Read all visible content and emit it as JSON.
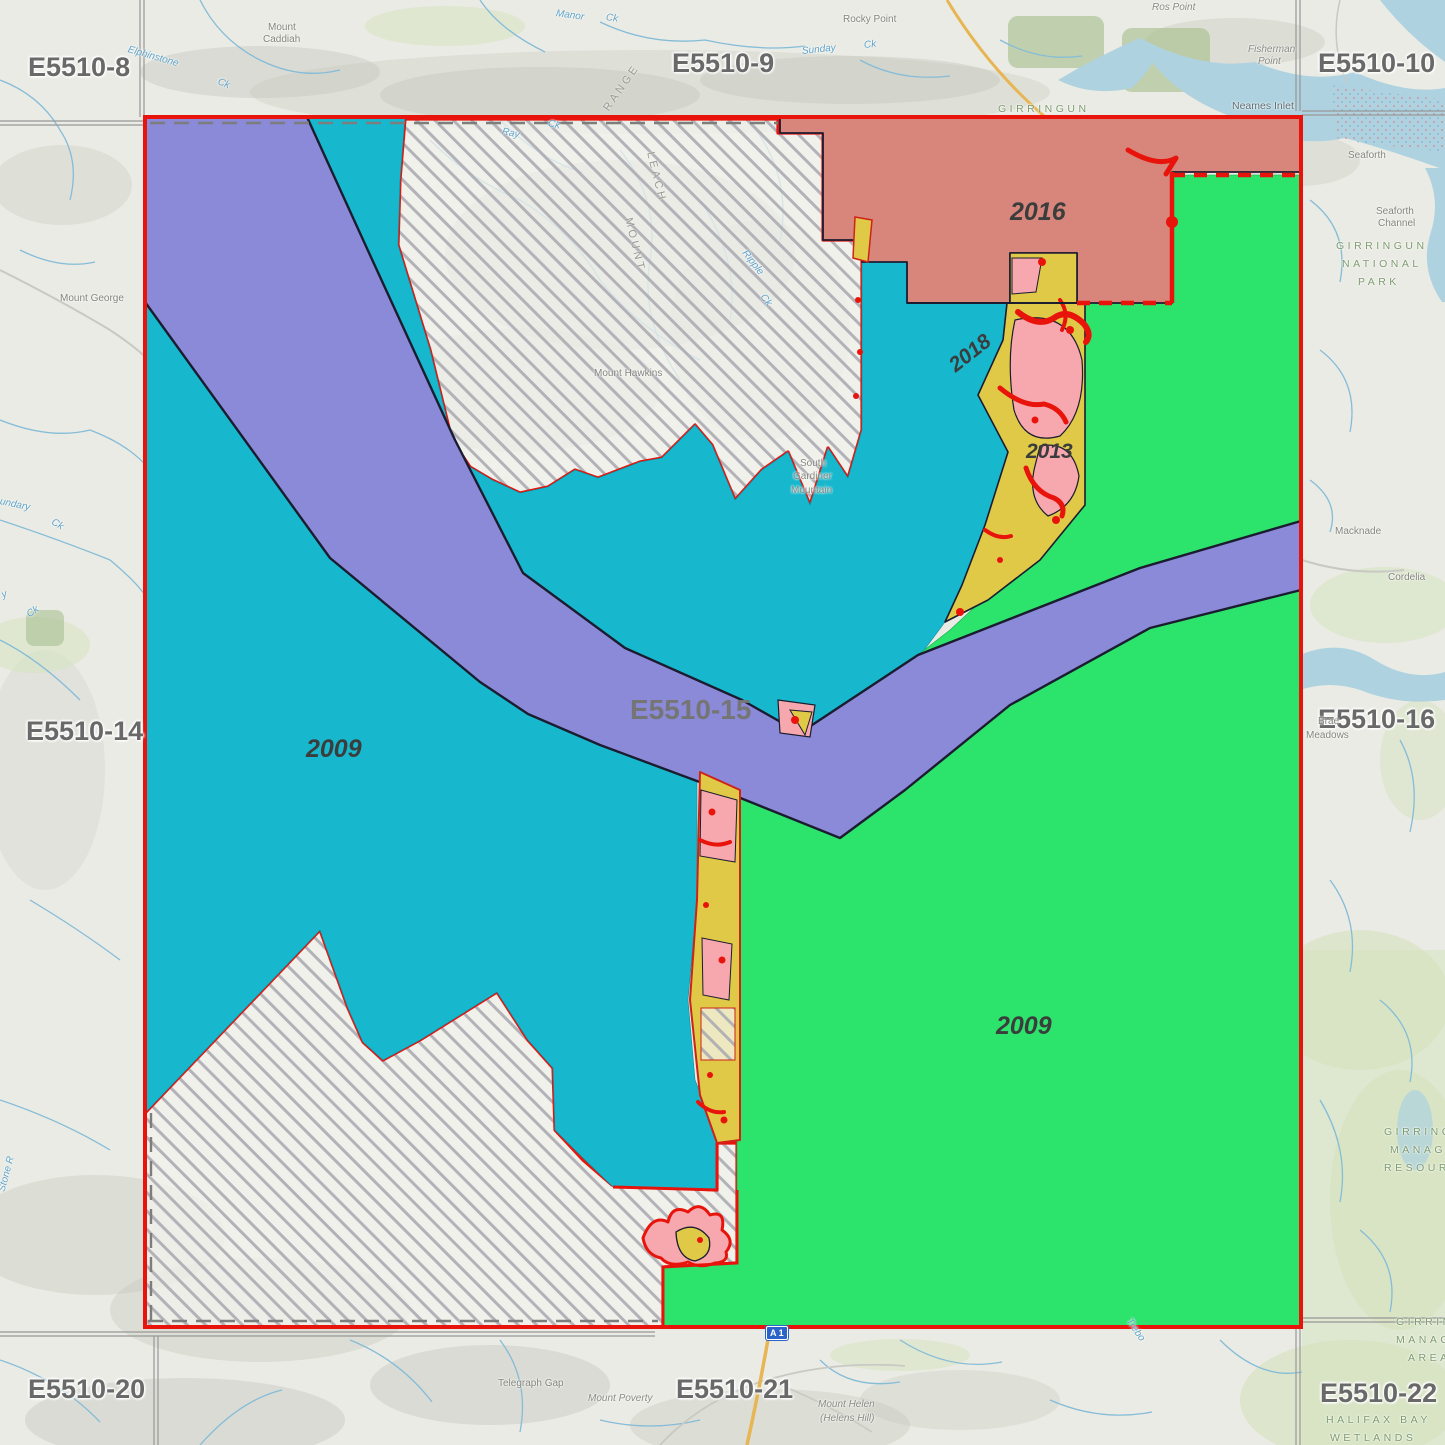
{
  "map_title": "Survey block index map E5510 with year-classified capture areas",
  "colors": {
    "teal_region": "#17b8ce",
    "purple_band": "#8a8ad9",
    "green_region": "#2ce36c",
    "salmon_region": "#d8857c",
    "pink_patch": "#f7a8ae",
    "yellow_strip": "#dfc947",
    "red_boundary": "#e8140c",
    "black_outline": "#1c1c30",
    "hatch_gray": "#b2b2b6",
    "water": "#aed2e0",
    "grid_gray": "#979797",
    "tile_label_gray": "#696969"
  },
  "region_year_labels": [
    {
      "t": "2016",
      "x": 1010,
      "y": 198,
      "s": 25
    },
    {
      "t": "2018",
      "x": 952,
      "y": 356,
      "s": 21,
      "r": -38
    },
    {
      "t": "2013",
      "x": 1026,
      "y": 440,
      "s": 21
    },
    {
      "t": "2009",
      "x": 306,
      "y": 735,
      "s": 25
    },
    {
      "t": "2009",
      "x": 996,
      "y": 1012,
      "s": 25
    }
  ],
  "tile_labels": [
    {
      "t": "E5510-8",
      "x": 28,
      "y": 52
    },
    {
      "t": "E5510-9",
      "x": 672,
      "y": 48
    },
    {
      "t": "E5510-10",
      "x": 1318,
      "y": 48
    },
    {
      "t": "E5510-14",
      "x": 26,
      "y": 716
    },
    {
      "t": "E5510-15",
      "x": 630,
      "y": 694,
      "c": "tile2"
    },
    {
      "t": "E5510-16",
      "x": 1318,
      "y": 704
    },
    {
      "t": "E5510-20",
      "x": 28,
      "y": 1374
    },
    {
      "t": "E5510-21",
      "x": 676,
      "y": 1374
    },
    {
      "t": "E5510-22",
      "x": 1320,
      "y": 1378
    }
  ],
  "place_labels": [
    {
      "t": "Mount",
      "x": 268,
      "y": 22,
      "c": "place"
    },
    {
      "t": "Caddiah",
      "x": 263,
      "y": 34,
      "c": "place"
    },
    {
      "t": "Rocky Point",
      "x": 843,
      "y": 14,
      "c": "place"
    },
    {
      "t": "Ros Point",
      "x": 1152,
      "y": 2,
      "c": "placeit"
    },
    {
      "t": "Fisherman",
      "x": 1248,
      "y": 44,
      "c": "placeit"
    },
    {
      "t": "Point",
      "x": 1258,
      "y": 56,
      "c": "placeit"
    },
    {
      "t": "Neames Inlet",
      "x": 1232,
      "y": 100,
      "c": "inlet"
    },
    {
      "t": "Seaforth",
      "x": 1348,
      "y": 150,
      "c": "place"
    },
    {
      "t": "Seaforth",
      "x": 1376,
      "y": 206,
      "c": "place"
    },
    {
      "t": "Channel",
      "x": 1378,
      "y": 218,
      "c": "place"
    },
    {
      "t": "GIRRINGUN",
      "x": 1336,
      "y": 240,
      "c": "park"
    },
    {
      "t": "NATIONAL",
      "x": 1342,
      "y": 258,
      "c": "park"
    },
    {
      "t": "PARK",
      "x": 1358,
      "y": 276,
      "c": "park"
    },
    {
      "t": "GIRRINGUN",
      "x": 998,
      "y": 103,
      "c": "park"
    },
    {
      "t": "Macknade",
      "x": 1335,
      "y": 526,
      "c": "place"
    },
    {
      "t": "Cordelia",
      "x": 1388,
      "y": 572,
      "c": "place"
    },
    {
      "t": "Brae",
      "x": 1318,
      "y": 716,
      "c": "place"
    },
    {
      "t": "Meadows",
      "x": 1306,
      "y": 730,
      "c": "place"
    },
    {
      "t": "Mount George",
      "x": 60,
      "y": 293,
      "c": "place"
    },
    {
      "t": "Mount Hawkins",
      "x": 594,
      "y": 368,
      "c": "place"
    },
    {
      "t": "South",
      "x": 800,
      "y": 458,
      "c": "place"
    },
    {
      "t": "Gardiner",
      "x": 793,
      "y": 471,
      "c": "place"
    },
    {
      "t": "Mountain",
      "x": 791,
      "y": 485,
      "c": "place"
    },
    {
      "t": "GIRRINGUN",
      "x": 1384,
      "y": 1126,
      "c": "park"
    },
    {
      "t": "MANAGED",
      "x": 1390,
      "y": 1144,
      "c": "park"
    },
    {
      "t": "RESOURCE",
      "x": 1384,
      "y": 1162,
      "c": "park"
    },
    {
      "t": "GIRRINGU",
      "x": 1396,
      "y": 1316,
      "c": "park"
    },
    {
      "t": "MANAGEME",
      "x": 1396,
      "y": 1334,
      "c": "park"
    },
    {
      "t": "AREA",
      "x": 1408,
      "y": 1352,
      "c": "park"
    },
    {
      "t": "HALIFAX BAY",
      "x": 1326,
      "y": 1414,
      "c": "park"
    },
    {
      "t": "WETLANDS",
      "x": 1330,
      "y": 1432,
      "c": "park"
    },
    {
      "t": "Telegraph Gap",
      "x": 498,
      "y": 1378,
      "c": "place"
    },
    {
      "t": "Mount Poverty",
      "x": 588,
      "y": 1393,
      "c": "placeit"
    },
    {
      "t": "Mount Helen",
      "x": 818,
      "y": 1399,
      "c": "placeit"
    },
    {
      "t": "(Helens Hill)",
      "x": 820,
      "y": 1413,
      "c": "placeit"
    },
    {
      "t": "RANGE",
      "x": 606,
      "y": 104,
      "c": "rangelbl",
      "r": -55
    },
    {
      "t": "LEACH",
      "x": 650,
      "y": 146,
      "c": "rangelbl",
      "r": 76
    },
    {
      "t": "MOUNT",
      "x": 628,
      "y": 212,
      "c": "rangelbl",
      "r": 76
    }
  ],
  "creek_labels": [
    {
      "t": "Elphinstone",
      "x": 128,
      "y": 44,
      "r": 16
    },
    {
      "t": "Ck",
      "x": 218,
      "y": 76,
      "r": 22
    },
    {
      "t": "Manor",
      "x": 556,
      "y": 8,
      "r": 8
    },
    {
      "t": "Ck",
      "x": 606,
      "y": 12,
      "r": 8
    },
    {
      "t": "Sunday",
      "x": 802,
      "y": 46,
      "r": -6
    },
    {
      "t": "Ck",
      "x": 864,
      "y": 40,
      "r": -6
    },
    {
      "t": "Ray",
      "x": 502,
      "y": 126,
      "r": 12
    },
    {
      "t": "Ck",
      "x": 548,
      "y": 118,
      "r": 12
    },
    {
      "t": "Ripple",
      "x": 744,
      "y": 246,
      "r": 52
    },
    {
      "t": "Ck",
      "x": 762,
      "y": 290,
      "r": 52
    },
    {
      "t": "undary",
      "x": 0,
      "y": 496,
      "r": 12
    },
    {
      "t": "Ck",
      "x": 52,
      "y": 516,
      "r": 30
    },
    {
      "t": "y",
      "x": 2,
      "y": 590,
      "r": -20
    },
    {
      "t": "Ck",
      "x": 28,
      "y": 610,
      "r": -35
    },
    {
      "t": "Stone R",
      "x": 2,
      "y": 1186,
      "r": -75
    },
    {
      "t": "Trebo",
      "x": 1128,
      "y": 1314,
      "r": 55
    }
  ],
  "road_shields": [
    {
      "t": "A 1",
      "x": 766,
      "y": 1326
    }
  ]
}
